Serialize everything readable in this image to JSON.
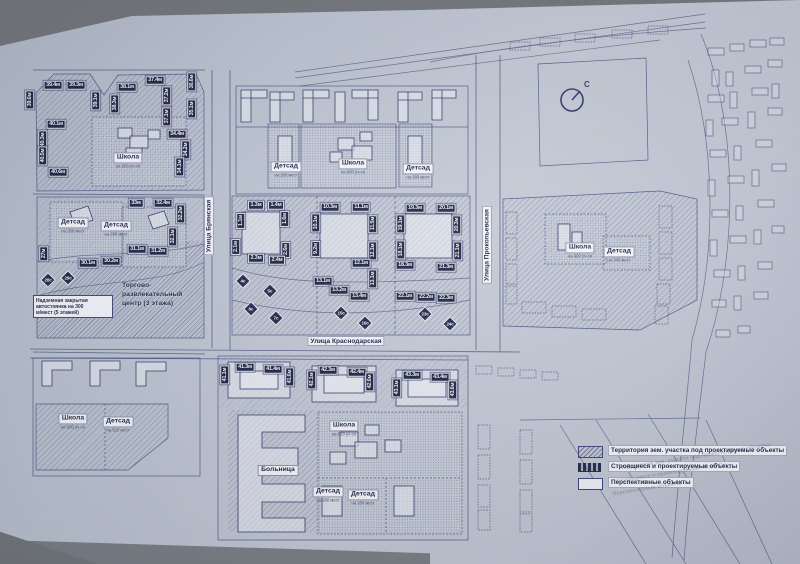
{
  "compass": {
    "label": "С"
  },
  "streets": [
    {
      "name": "Улица Брянская",
      "orientation": "vertical"
    },
    {
      "name": "Улица Краснодарская",
      "orientation": "horizontal"
    },
    {
      "name": "Улица Прокопьевская",
      "orientation": "vertical"
    }
  ],
  "notes": {
    "parking_lines": [
      "Надземная закрытая",
      "автостоянка на 300",
      "м/мест (5 этажей)"
    ],
    "mall_lines": [
      "Торгово-",
      "развлекательный",
      "центр (3 этажа)"
    ]
  },
  "legend": {
    "items": [
      {
        "label": "Территория зем. участка под проектируемые объекты",
        "swatch": "hatch"
      },
      {
        "label": "Строящиеся и проектируемые объекты",
        "swatch": "dark"
      },
      {
        "label": "Перспективные объекты",
        "swatch": "outline"
      }
    ]
  },
  "facilities": [
    {
      "t": "Школа",
      "s": "на 600 уч-ся",
      "x": 128,
      "y": 157
    },
    {
      "t": "Детсад",
      "s": "на 280 мест",
      "x": 73,
      "y": 222
    },
    {
      "t": "Детсад",
      "s": "на 280 мест",
      "x": 116,
      "y": 225
    },
    {
      "t": "Детсад",
      "s": "на 280 мест",
      "x": 286,
      "y": 166
    },
    {
      "t": "Школа",
      "s": "на 600 уч-ся",
      "x": 353,
      "y": 163
    },
    {
      "t": "Детсад",
      "s": "на 280 мест",
      "x": 418,
      "y": 168
    },
    {
      "t": "Школа",
      "s": "на 600 уч-ся",
      "x": 580,
      "y": 247
    },
    {
      "t": "Детсад",
      "s": "на 340 мест",
      "x": 619,
      "y": 251
    },
    {
      "t": "Школа",
      "s": "на 600 уч-ся",
      "x": 73,
      "y": 418
    },
    {
      "t": "Детсад",
      "s": "на 320 мест",
      "x": 118,
      "y": 421
    },
    {
      "t": "Школа",
      "s": "на 600 уч-ся",
      "x": 344,
      "y": 425
    },
    {
      "t": "Больница",
      "s": "",
      "x": 278,
      "y": 467
    },
    {
      "t": "Детсад",
      "s": "на 280 мест",
      "x": 328,
      "y": 491
    },
    {
      "t": "Детсад",
      "s": "на 280 мест",
      "x": 363,
      "y": 494
    }
  ],
  "measure_tags": [
    {
      "t": "39.4м",
      "x": 53,
      "y": 85,
      "v": 0
    },
    {
      "t": "39.3м",
      "x": 76,
      "y": 85,
      "v": 0
    },
    {
      "t": "39.1м",
      "x": 96,
      "y": 101,
      "v": 1
    },
    {
      "t": "38.1м",
      "x": 127,
      "y": 87,
      "v": 0
    },
    {
      "t": "38.3м",
      "x": 115,
      "y": 104,
      "v": 1
    },
    {
      "t": "37.4м",
      "x": 155,
      "y": 80,
      "v": 0
    },
    {
      "t": "37.2м",
      "x": 167,
      "y": 96,
      "v": 1
    },
    {
      "t": "36.6м",
      "x": 192,
      "y": 82,
      "v": 1
    },
    {
      "t": "35.1м",
      "x": 192,
      "y": 109,
      "v": 1
    },
    {
      "t": "39.6м",
      "x": 30,
      "y": 100,
      "v": 1
    },
    {
      "t": "40.1м",
      "x": 56,
      "y": 124,
      "v": 0
    },
    {
      "t": "40.3м",
      "x": 43,
      "y": 140,
      "v": 1
    },
    {
      "t": "40.5м",
      "x": 43,
      "y": 156,
      "v": 1
    },
    {
      "t": "40.6м",
      "x": 58,
      "y": 172,
      "v": 0
    },
    {
      "t": "37.1м",
      "x": 167,
      "y": 117,
      "v": 1
    },
    {
      "t": "34.4м",
      "x": 177,
      "y": 134,
      "v": 0
    },
    {
      "t": "34.2м",
      "x": 186,
      "y": 150,
      "v": 1
    },
    {
      "t": "34.1м",
      "x": 180,
      "y": 167,
      "v": 1
    },
    {
      "t": "33м",
      "x": 136,
      "y": 203,
      "v": 0
    },
    {
      "t": "32.4м",
      "x": 163,
      "y": 203,
      "v": 0
    },
    {
      "t": "32.2м",
      "x": 181,
      "y": 214,
      "v": 1
    },
    {
      "t": "32.1м",
      "x": 173,
      "y": 237,
      "v": 1
    },
    {
      "t": "31.1м",
      "x": 137,
      "y": 249,
      "v": 0
    },
    {
      "t": "31.2м",
      "x": 158,
      "y": 251,
      "v": 0
    },
    {
      "t": "30.1м",
      "x": 88,
      "y": 263,
      "v": 0
    },
    {
      "t": "30.2м",
      "x": 111,
      "y": 261,
      "v": 0
    },
    {
      "t": "27м",
      "x": 44,
      "y": 254,
      "v": 1
    },
    {
      "t": "1.3м",
      "x": 256,
      "y": 205,
      "v": 0
    },
    {
      "t": "1.4м",
      "x": 276,
      "y": 205,
      "v": 0
    },
    {
      "t": "1.1м",
      "x": 241,
      "y": 221,
      "v": 1
    },
    {
      "t": "2.1м",
      "x": 236,
      "y": 247,
      "v": 1
    },
    {
      "t": "1.6м",
      "x": 285,
      "y": 219,
      "v": 1
    },
    {
      "t": "2.6м",
      "x": 286,
      "y": 250,
      "v": 1
    },
    {
      "t": "2.3м",
      "x": 256,
      "y": 258,
      "v": 0
    },
    {
      "t": "2.4м",
      "x": 277,
      "y": 260,
      "v": 0
    },
    {
      "t": "10.3м",
      "x": 330,
      "y": 207,
      "v": 0
    },
    {
      "t": "11.1м",
      "x": 361,
      "y": 207,
      "v": 0
    },
    {
      "t": "10.1м",
      "x": 316,
      "y": 223,
      "v": 1
    },
    {
      "t": "11.5м",
      "x": 373,
      "y": 224,
      "v": 1
    },
    {
      "t": "9.2м",
      "x": 316,
      "y": 249,
      "v": 1
    },
    {
      "t": "12.1м",
      "x": 373,
      "y": 251,
      "v": 1
    },
    {
      "t": "12.1м",
      "x": 361,
      "y": 263,
      "v": 0
    },
    {
      "t": "13.1м",
      "x": 373,
      "y": 279,
      "v": 1
    },
    {
      "t": "13.1м",
      "x": 323,
      "y": 281,
      "v": 0
    },
    {
      "t": "13.2м",
      "x": 339,
      "y": 290,
      "v": 0
    },
    {
      "t": "13.4м",
      "x": 359,
      "y": 296,
      "v": 0
    },
    {
      "t": "19.3м",
      "x": 415,
      "y": 208,
      "v": 0
    },
    {
      "t": "20.1м",
      "x": 446,
      "y": 208,
      "v": 0
    },
    {
      "t": "19.1м",
      "x": 401,
      "y": 224,
      "v": 1
    },
    {
      "t": "20.3м",
      "x": 457,
      "y": 225,
      "v": 1
    },
    {
      "t": "18.1м",
      "x": 401,
      "y": 250,
      "v": 1
    },
    {
      "t": "21.1м",
      "x": 458,
      "y": 251,
      "v": 1
    },
    {
      "t": "18.3м",
      "x": 405,
      "y": 265,
      "v": 0
    },
    {
      "t": "21.3м",
      "x": 446,
      "y": 267,
      "v": 0
    },
    {
      "t": "22.1м",
      "x": 405,
      "y": 296,
      "v": 0
    },
    {
      "t": "22.2м",
      "x": 426,
      "y": 297,
      "v": 0
    },
    {
      "t": "22.3м",
      "x": 446,
      "y": 298,
      "v": 0
    },
    {
      "t": "41.1м",
      "x": 225,
      "y": 375,
      "v": 1
    },
    {
      "t": "41.3м",
      "x": 245,
      "y": 367,
      "v": 0
    },
    {
      "t": "41.4м",
      "x": 273,
      "y": 369,
      "v": 0
    },
    {
      "t": "41.6м",
      "x": 290,
      "y": 377,
      "v": 1
    },
    {
      "t": "42.1м",
      "x": 312,
      "y": 380,
      "v": 1
    },
    {
      "t": "42.3м",
      "x": 328,
      "y": 370,
      "v": 0
    },
    {
      "t": "42.4м",
      "x": 357,
      "y": 372,
      "v": 0
    },
    {
      "t": "42.6м",
      "x": 370,
      "y": 382,
      "v": 1
    },
    {
      "t": "43.1м",
      "x": 397,
      "y": 388,
      "v": 1
    },
    {
      "t": "43.3м",
      "x": 412,
      "y": 375,
      "v": 0
    },
    {
      "t": "43.4м",
      "x": 440,
      "y": 377,
      "v": 0
    },
    {
      "t": "43.6м",
      "x": 453,
      "y": 390,
      "v": 1
    }
  ],
  "site_tags": [
    {
      "t": "4с",
      "x": 243,
      "y": 281
    },
    {
      "t": "5с",
      "x": 270,
      "y": 291
    },
    {
      "t": "6с",
      "x": 251,
      "y": 309
    },
    {
      "t": "7с",
      "x": 276,
      "y": 318
    },
    {
      "t": "15с",
      "x": 341,
      "y": 313
    },
    {
      "t": "16с",
      "x": 365,
      "y": 323
    },
    {
      "t": "23с",
      "x": 425,
      "y": 314
    },
    {
      "t": "24с",
      "x": 450,
      "y": 324
    },
    {
      "t": "28с",
      "x": 48,
      "y": 280
    },
    {
      "t": "29с",
      "x": 68,
      "y": 278
    }
  ]
}
